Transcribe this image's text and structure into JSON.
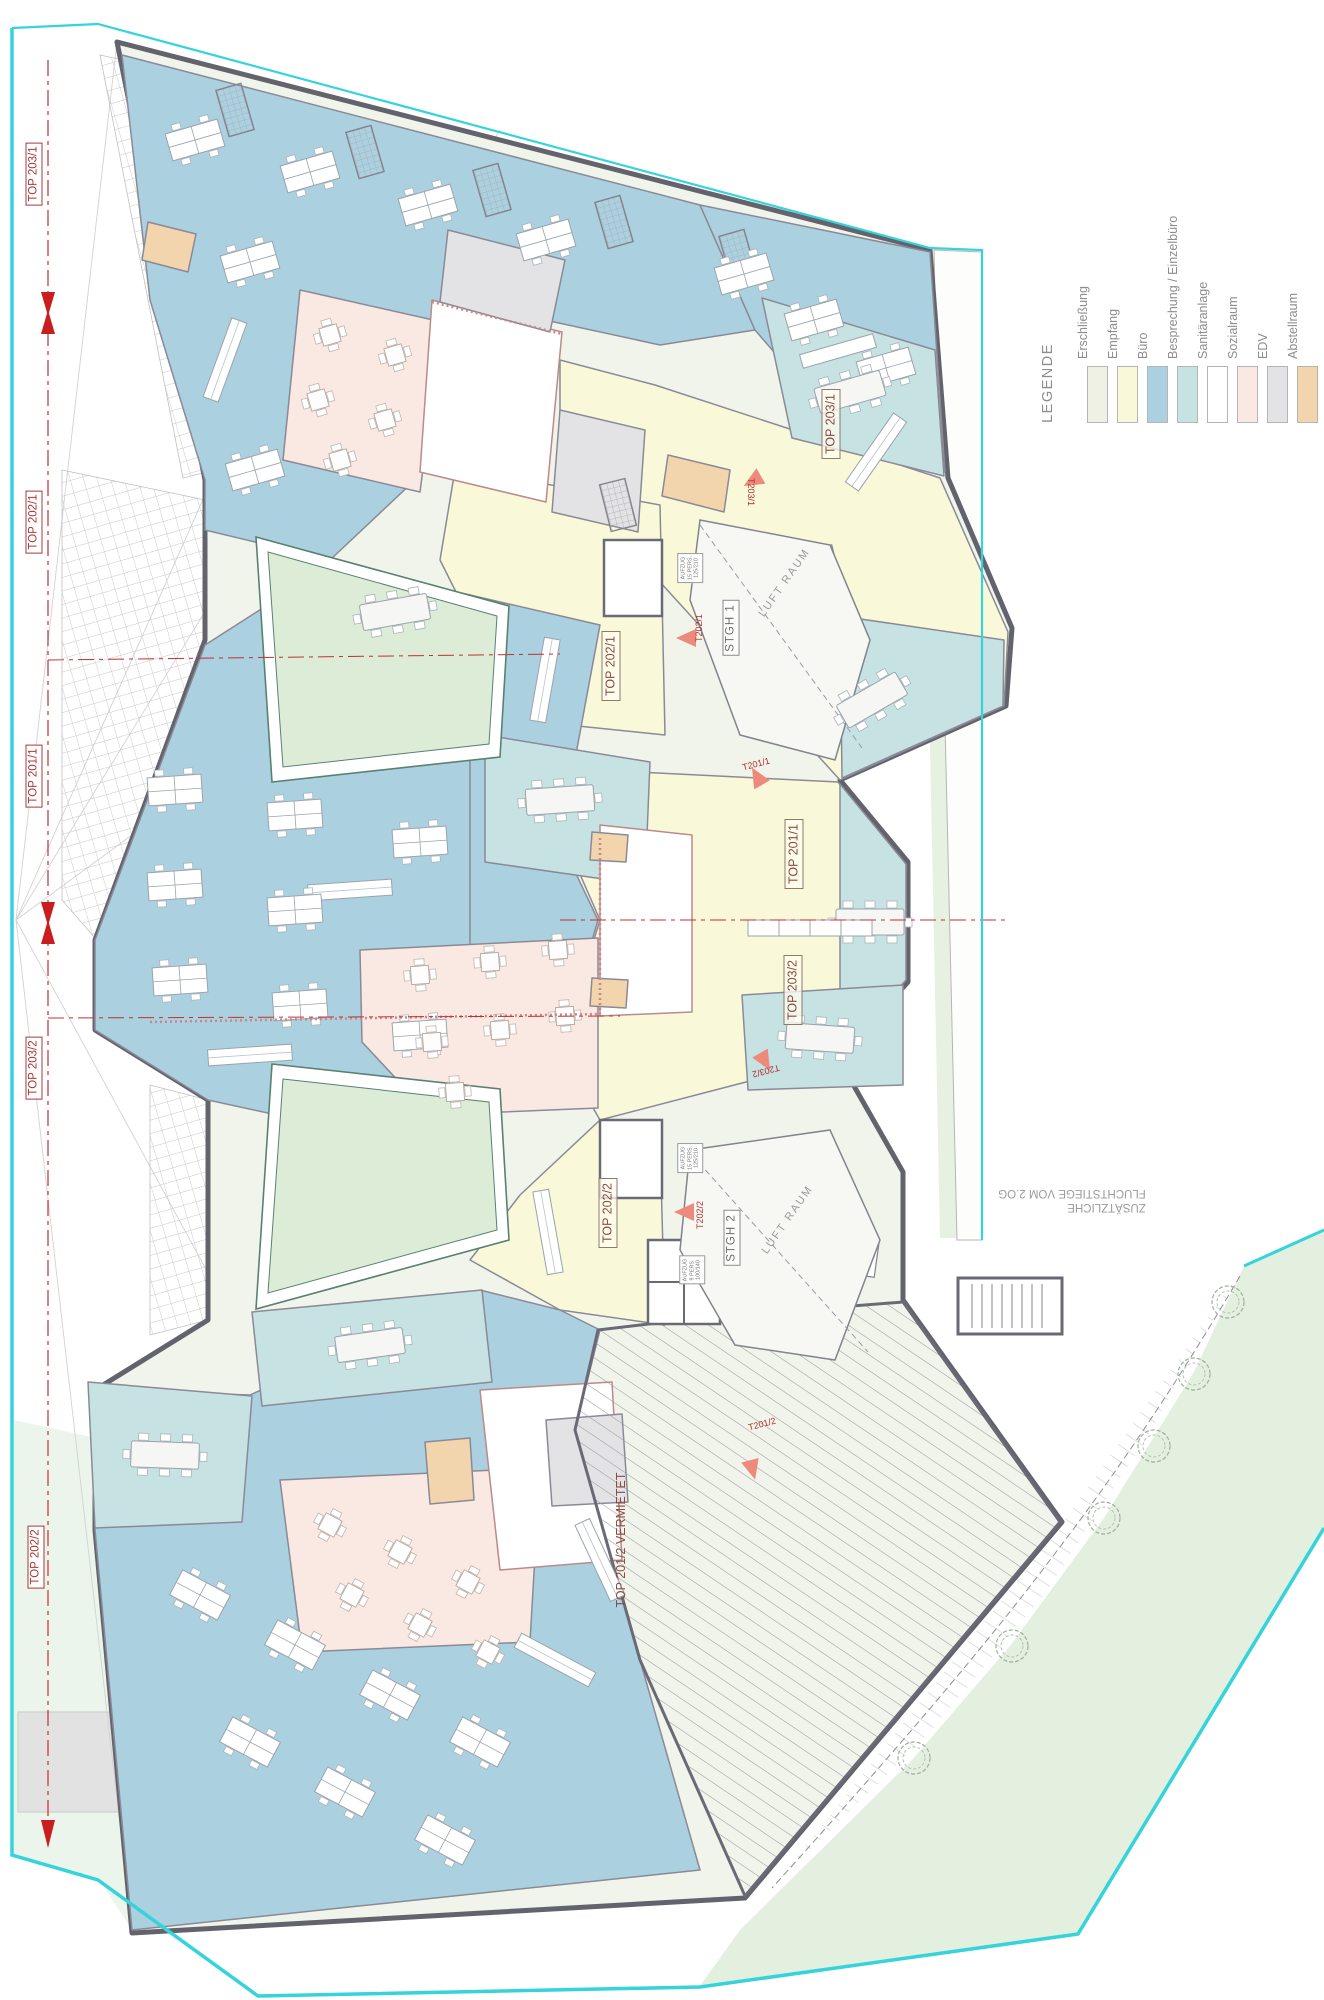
{
  "legend": {
    "title": "LEGENDE",
    "items": [
      {
        "label": "Erschließung",
        "color": "#eef1e3"
      },
      {
        "label": "Empfang",
        "color": "#f9f9da"
      },
      {
        "label": "Büro",
        "color": "#abd0e0"
      },
      {
        "label": "Besprechung / Einzelbüro",
        "color": "#c7e2e3"
      },
      {
        "label": "Sanitäranlage",
        "color": "#ffffff"
      },
      {
        "label": "Sozialraum",
        "color": "#f9e9e2"
      },
      {
        "label": "EDV",
        "color": "#e3e3e5"
      },
      {
        "label": "Abstellraum",
        "color": "#f2d4ad"
      }
    ]
  },
  "units": {
    "top203_1": "TOP 203/1",
    "top202_1": "TOP 202/1",
    "top201_1": "TOP 201/1",
    "top203_2": "TOP 203/2",
    "top202_2": "TOP 202/2",
    "top201_2_vermietet": "TOP 201/2 VERMIETET"
  },
  "stairs": {
    "stgh1": "STGH 1",
    "stgh2": "STGH 2"
  },
  "voids": {
    "luftraum": "LUFT RAUM"
  },
  "doors": {
    "t203_1": "T203/1",
    "t202_1": "T202/1",
    "t201_1": "T201/1",
    "t203_2": "T203/2",
    "t202_2": "T202/2",
    "t201_2": "T201/2"
  },
  "elevators": {
    "large": [
      "AUFZUG",
      "15 PERS.",
      "125/210"
    ],
    "small": [
      "AUFZUG",
      "9 PERS.",
      "100/140"
    ]
  },
  "annotations": {
    "escape_line1": "ZUSÄTZLICHE",
    "escape_line2": "FLUCHTSTIEGE VOM 2.OG"
  },
  "colors": {
    "boundary_cyan": "#35d3da",
    "section_red": "#c03030",
    "label_red": "#a83838",
    "wall_gray": "#66666f",
    "courtyard_green": "#dcecd7"
  }
}
